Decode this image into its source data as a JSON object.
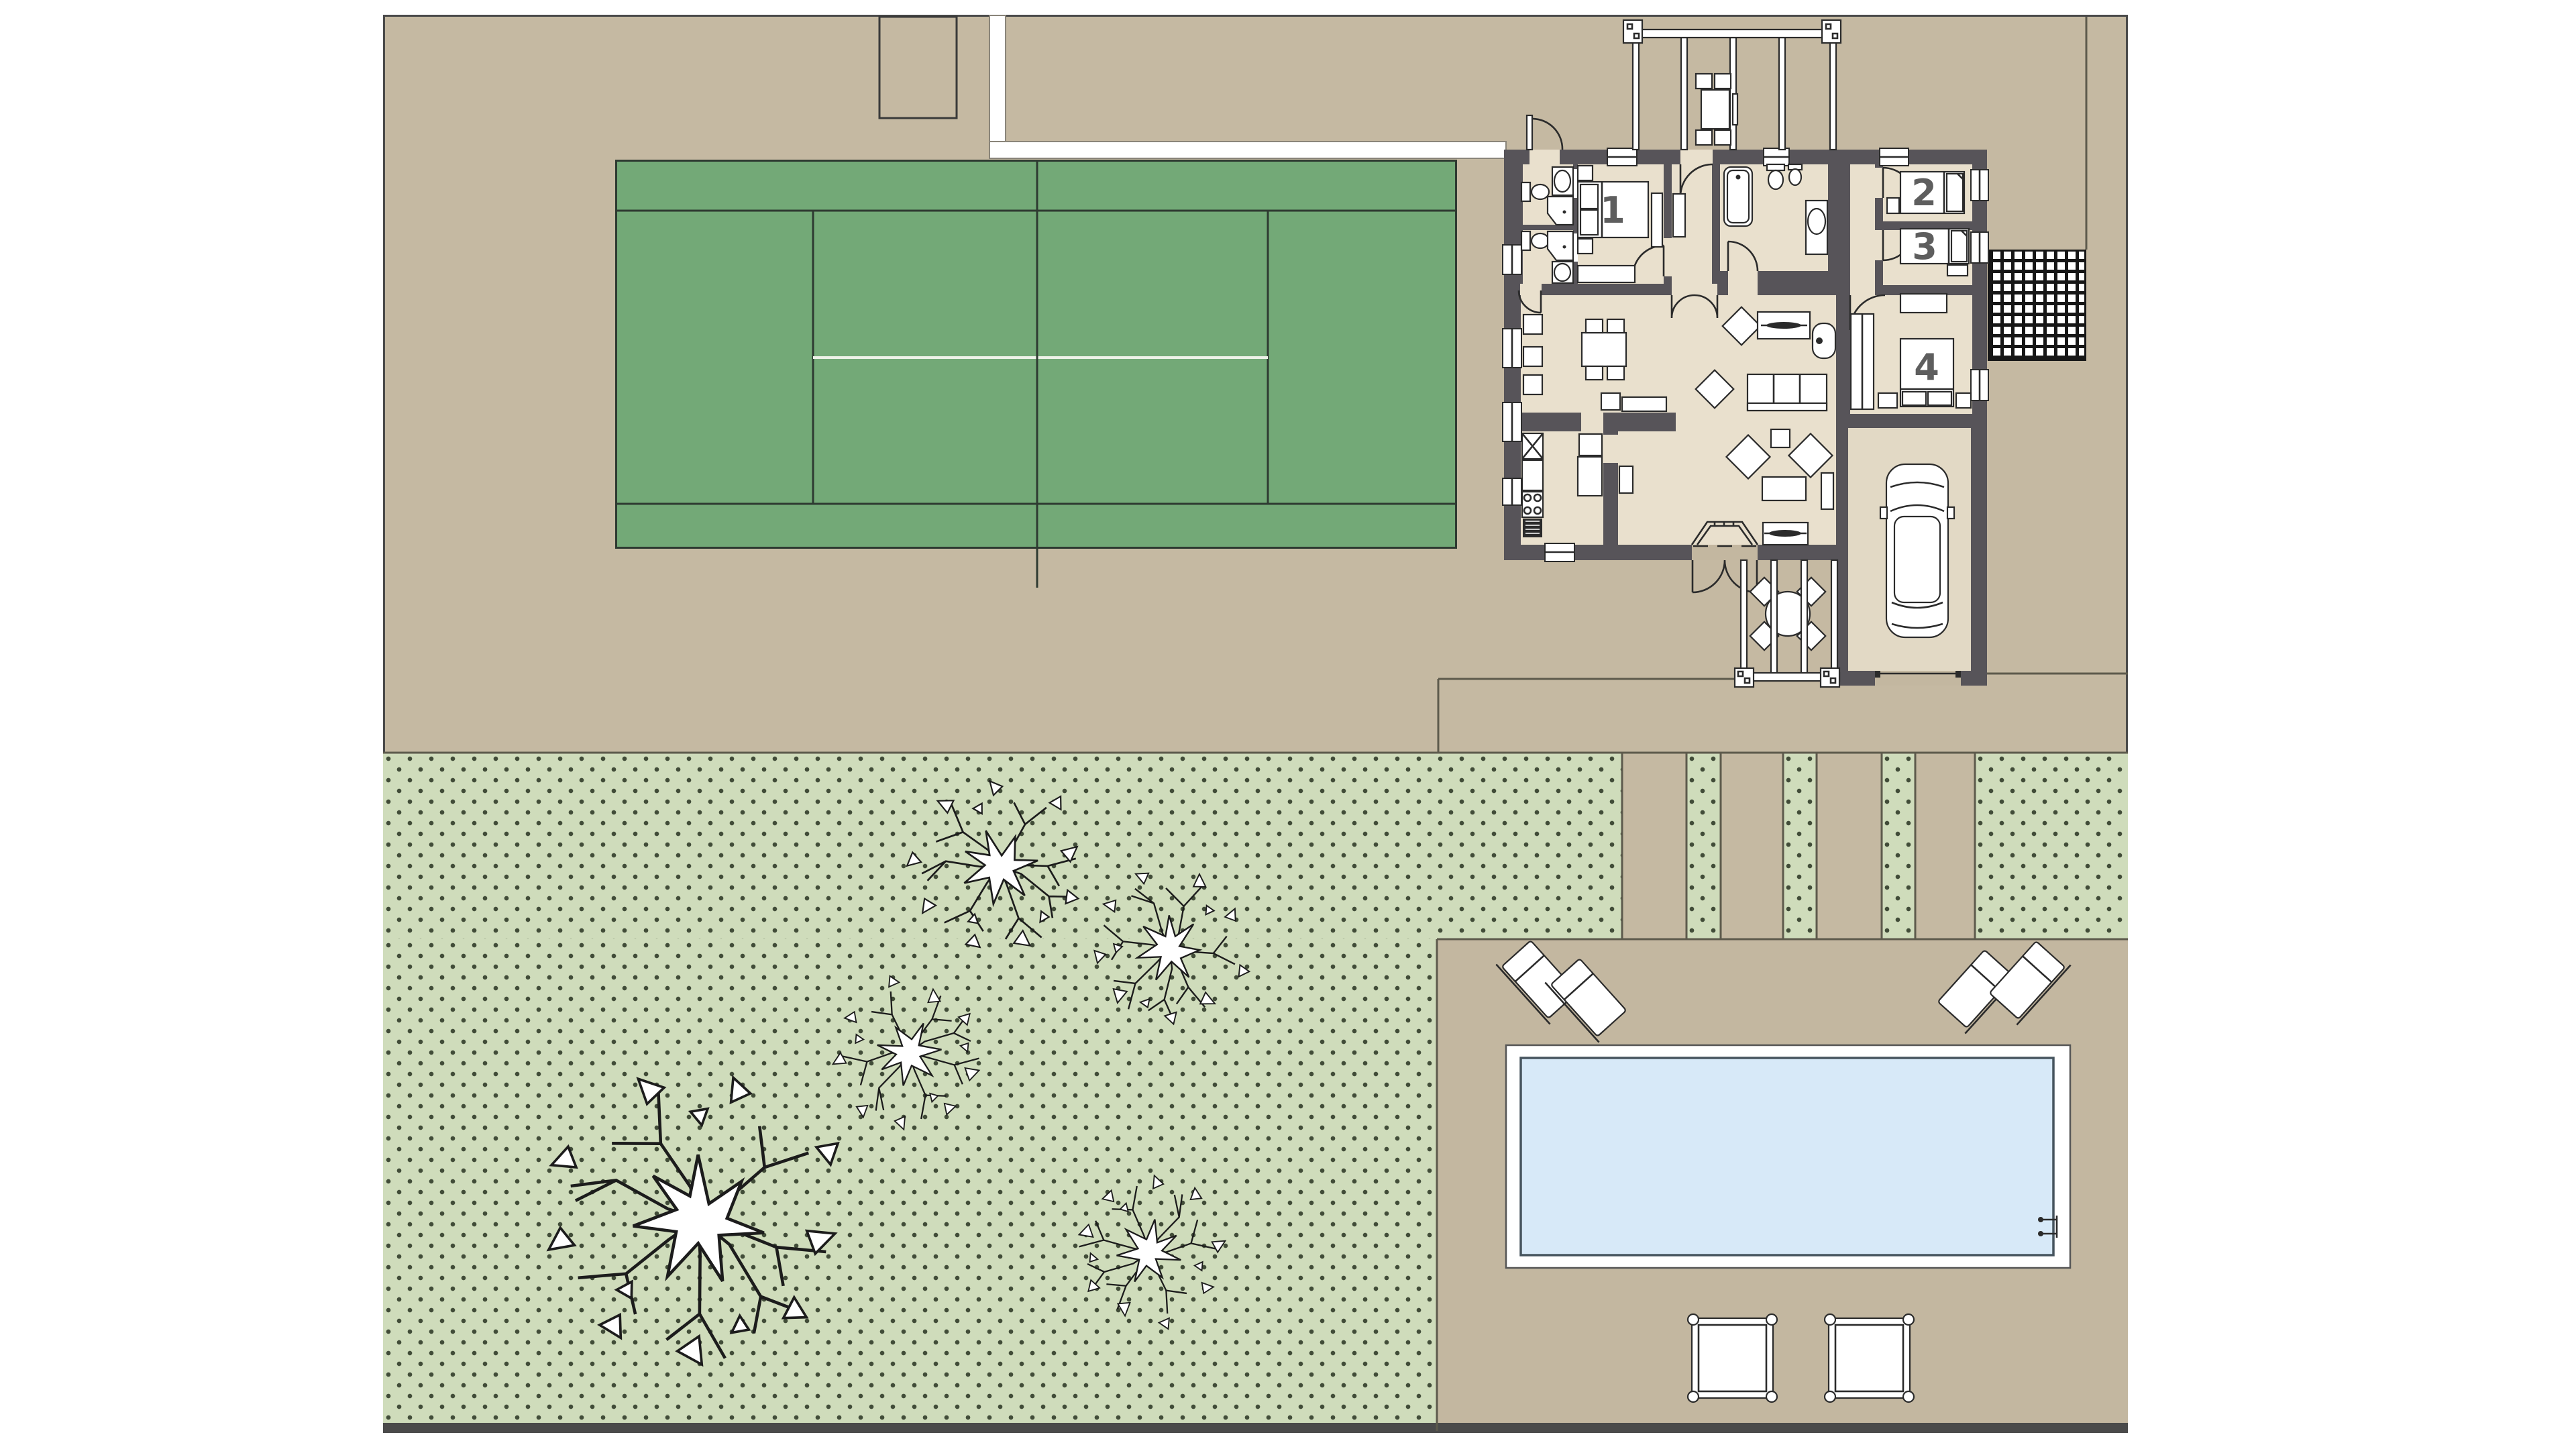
{
  "document": {
    "type": "architectural-site-plan",
    "title": "Villa site plan with tennis court, garden and swimming pool"
  },
  "rooms": [
    {
      "id": "bedroom-1",
      "label": "1"
    },
    {
      "id": "bedroom-2",
      "label": "2"
    },
    {
      "id": "bedroom-3",
      "label": "3"
    },
    {
      "id": "bedroom-4",
      "label": "4"
    }
  ],
  "site": {
    "trees": 5,
    "sun_loungers": 4,
    "terrace_platforms": 2,
    "pergolas": 2,
    "parked_cars": 1
  },
  "palette": {
    "page_background": "#ffffff",
    "plot_tan": "#c5b9a2",
    "terrace_tan": "#c3b7a0",
    "garden_green": "#cfdcbb",
    "garden_dot": "#414c38",
    "court_green": "#73a977",
    "court_line": "#2e3a31",
    "court_center_line": "#edf2e8",
    "house_floor": "#e9e0cd",
    "garage_floor": "#e2d9c5",
    "wall_gray": "#575459",
    "fixture_stroke": "#2b2b2b",
    "pool_water": "#d7e9f8",
    "pool_deck": "#ffffff",
    "label_gray": "#5e5e5e",
    "boundary_line": "#4a4a4a"
  }
}
